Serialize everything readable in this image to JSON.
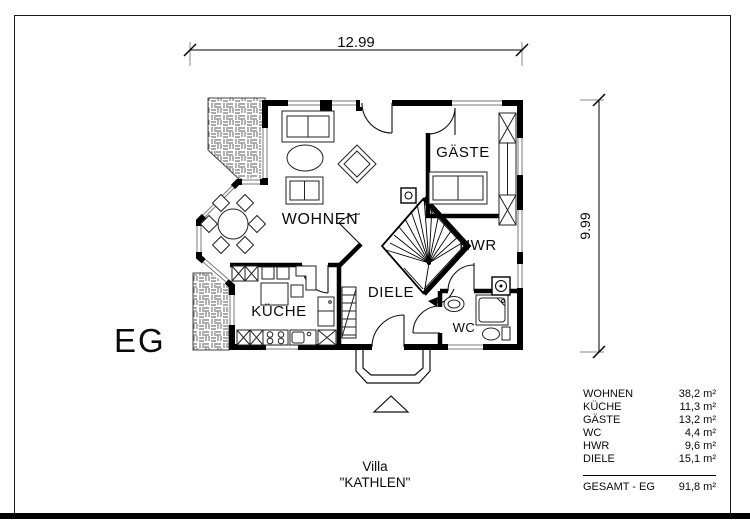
{
  "header": {
    "floor_label": "EG"
  },
  "title": {
    "line1": "Villa",
    "line2": "\"KATHLEN\""
  },
  "dimensions": {
    "width_label": "12.99",
    "height_label": "9.99"
  },
  "room_labels": {
    "wohnen": "WOHNEN",
    "gaeste": "GÄSTE",
    "hwr": "HWR",
    "diele": "DIELE",
    "kueche": "KÜCHE",
    "wc": "WC"
  },
  "area_table": {
    "rows": [
      {
        "label": "WOHNEN",
        "value": "38,2 m²"
      },
      {
        "label": "KÜCHE",
        "value": "11,3 m²"
      },
      {
        "label": "GÄSTE",
        "value": "13,2 m²"
      },
      {
        "label": "WC",
        "value": "4,4 m²"
      },
      {
        "label": "HWR",
        "value": "9,6 m²"
      },
      {
        "label": "DIELE",
        "value": "15,1 m²"
      }
    ],
    "total_label": "GESAMT - EG",
    "total_value": "91,8 m²"
  }
}
